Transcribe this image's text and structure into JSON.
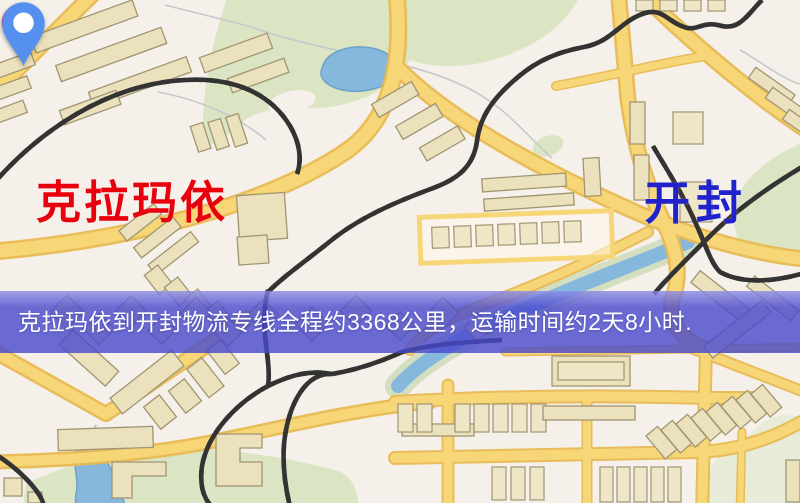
{
  "map": {
    "origin": {
      "name": "克拉玛依",
      "pin_icon": "red-location-pin",
      "pin_color": "#ed1515",
      "label_color": "#e8000d"
    },
    "destination": {
      "name": "开封",
      "pin_icon": "blue-location-pin",
      "pin_color": "#5590f0",
      "label_color": "#2222cc"
    }
  },
  "banner": {
    "text": "克拉玛依到开封物流专线全程约3368公里，运输时间约2天8小时.",
    "background_color": "#4848cd",
    "text_color": "#ffffff"
  },
  "palette": {
    "map_background": "#f6f0ea",
    "road_yellow": "#f7d678",
    "road_casing": "#e8ba52",
    "park_green": "#dbe5c3",
    "pale_green": "#e7ecd8",
    "water_blue": "#86b7dc",
    "building_fill": "#ece1bd",
    "building_stroke": "#a09572",
    "railway_dark": "#333333"
  }
}
